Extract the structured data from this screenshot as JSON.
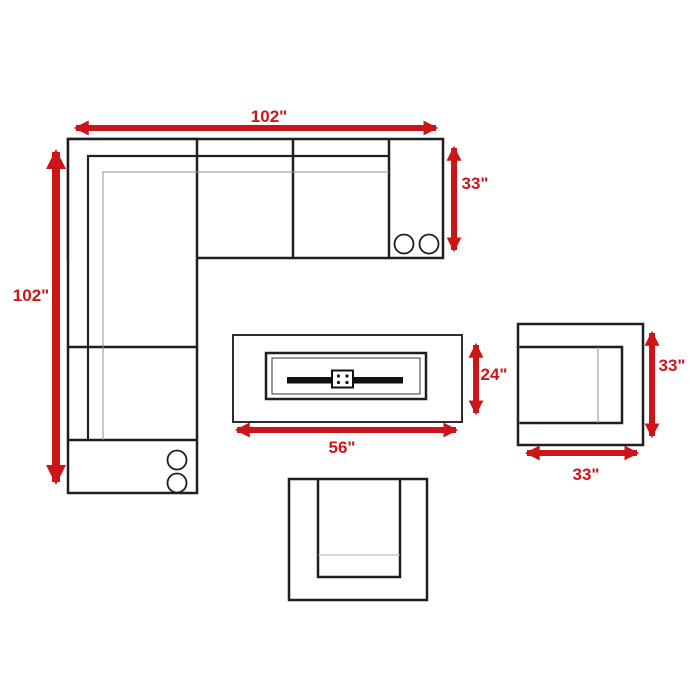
{
  "colors": {
    "background": "#ffffff",
    "dimension_red": "#cc1519",
    "outline_dark": "#1e1e1e",
    "outline_light": "#909090"
  },
  "dimensions": {
    "sectional": {
      "width": "102\"",
      "depth": "33\"",
      "length": "102\""
    },
    "fire_pit_table": {
      "width": "56\"",
      "depth": "24\""
    },
    "club_chair": {
      "depth": "33\"",
      "width": "33\""
    }
  }
}
